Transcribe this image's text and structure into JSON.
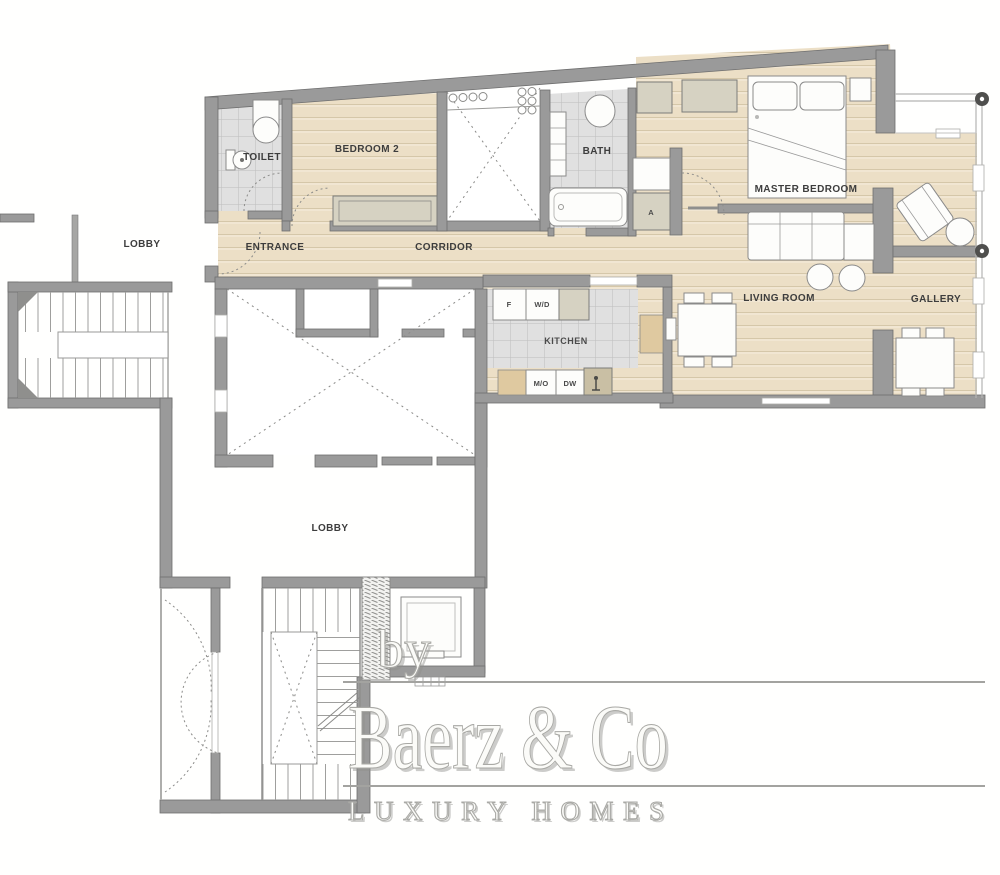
{
  "title": "Apartment floor plan",
  "rooms": {
    "toilet": "TOILET",
    "bedroom2": "BEDROOM 2",
    "bath": "BATH",
    "master": "MASTER BEDROOM",
    "lobby_upper": "LOBBY",
    "entrance": "ENTRANCE",
    "corridor": "CORRIDOR",
    "living": "LIVING ROOM",
    "gallery": "GALLERY",
    "kitchen": "KITCHEN",
    "lobby_lower": "LOBBY",
    "closet_a": "A"
  },
  "appliances": {
    "fridge": "F",
    "washer_dryer": "W/D",
    "micro_oven": "M/O",
    "dishwasher": "DW"
  },
  "watermark": {
    "by": "by",
    "brand": "Baerz & Co",
    "tagline": "LUXURY HOMES"
  },
  "colors": {
    "wall": "#9a9a9a",
    "wood_floor": "#ecdfc6",
    "tile": "#e0e0e0",
    "label": "#3d3d3d",
    "watermark": "#a9a9a5"
  }
}
